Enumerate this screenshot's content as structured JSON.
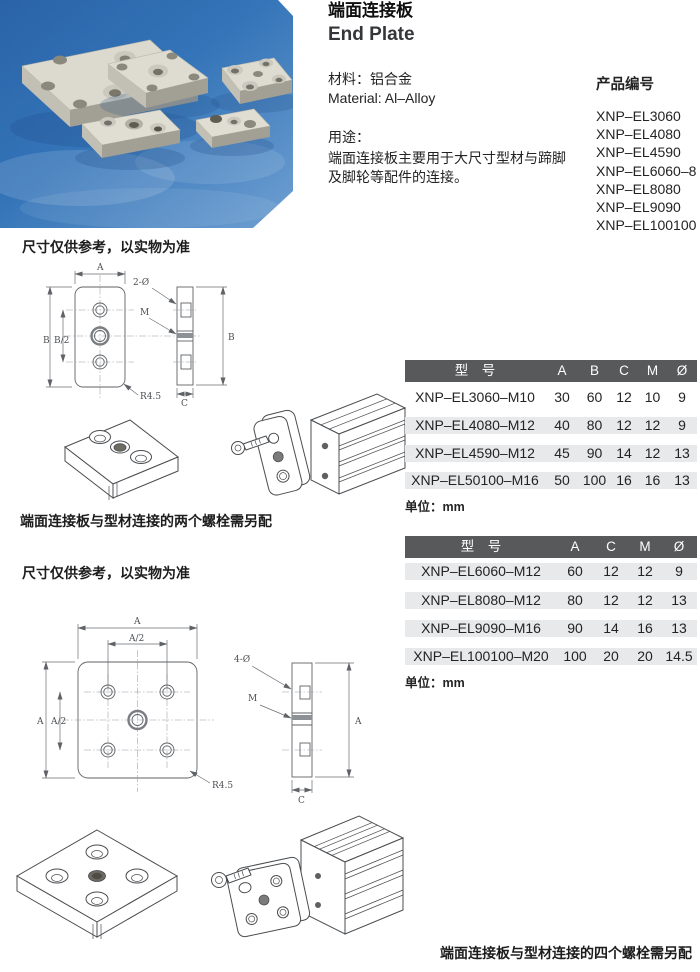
{
  "photo": {
    "description": "Five aluminum end plates on a blue background",
    "bg_top": "#2a63a8",
    "bg_mid": "#3474b8",
    "bg_bottom": "#6fa0d2",
    "plate_color": "#dcd9cf"
  },
  "header": {
    "title_cn": "端面连接板",
    "title_en": "End Plate",
    "material_cn": "材料：铝合金",
    "material_en": "Material: Al–Alloy",
    "usage_heading": "用途：",
    "usage_lines": [
      "端面连接板主要用于大尺寸型材与蹄脚",
      "及脚轮等配件的连接。"
    ],
    "codes_heading": "产品编号",
    "codes": [
      "XNP–EL3060",
      "XNP–EL4080",
      "XNP–EL4590",
      "XNP–EL6060–8",
      "XNP–EL8080",
      "XNP–EL9090",
      "XNP–EL100100"
    ]
  },
  "section1": {
    "note": "尺寸仅供参考，以实物为准",
    "caption": "端面连接板与型材连接的两个螺栓需另配",
    "labels": {
      "a": "A",
      "b": "B",
      "b2": "B/2",
      "c": "C",
      "m": "M",
      "holes": "2-Ø",
      "r": "R4.5"
    },
    "table": {
      "headers": [
        "型　号",
        "A",
        "B",
        "C",
        "M",
        "Ø"
      ],
      "rows": [
        {
          "model": "XNP–EL3060–M10",
          "values": [
            "30",
            "60",
            "12",
            "10",
            "9"
          ],
          "shaded": false
        },
        {
          "model": "XNP–EL4080–M12",
          "values": [
            "40",
            "80",
            "12",
            "12",
            "9"
          ],
          "shaded": true
        },
        {
          "model": "XNP–EL4590–M12",
          "values": [
            "45",
            "90",
            "14",
            "12",
            "13"
          ],
          "shaded": true
        },
        {
          "model": "XNP–EL50100–M16",
          "values": [
            "50",
            "100",
            "16",
            "16",
            "13"
          ],
          "shaded": true
        }
      ],
      "unit": "单位：mm"
    }
  },
  "section2": {
    "note": "尺寸仅供参考，以实物为准",
    "caption": "端面连接板与型材连接的四个螺栓需另配",
    "labels": {
      "a": "A",
      "a2": "A/2",
      "c": "C",
      "m": "M",
      "holes": "4-Ø",
      "r": "R4.5"
    },
    "table": {
      "headers": [
        "型　号",
        "A",
        "C",
        "M",
        "Ø"
      ],
      "rows": [
        {
          "model": "XNP–EL6060–M12",
          "values": [
            "60",
            "12",
            "12",
            "9"
          ],
          "shaded": true
        },
        {
          "model": "XNP–EL8080–M12",
          "values": [
            "80",
            "12",
            "12",
            "13"
          ],
          "shaded": true
        },
        {
          "model": "XNP–EL9090–M16",
          "values": [
            "90",
            "14",
            "16",
            "13"
          ],
          "shaded": true
        },
        {
          "model": "XNP–EL100100–M20",
          "values": [
            "100",
            "20",
            "20",
            "14.5"
          ],
          "shaded": true
        }
      ],
      "unit": "单位：mm"
    }
  },
  "colors": {
    "table_header_bg": "#58595b",
    "table_header_text": "#ffffff",
    "row_band": "#e8e9ea",
    "drawing_stroke": "#5f6266",
    "photo_blue": "#3474b8"
  }
}
